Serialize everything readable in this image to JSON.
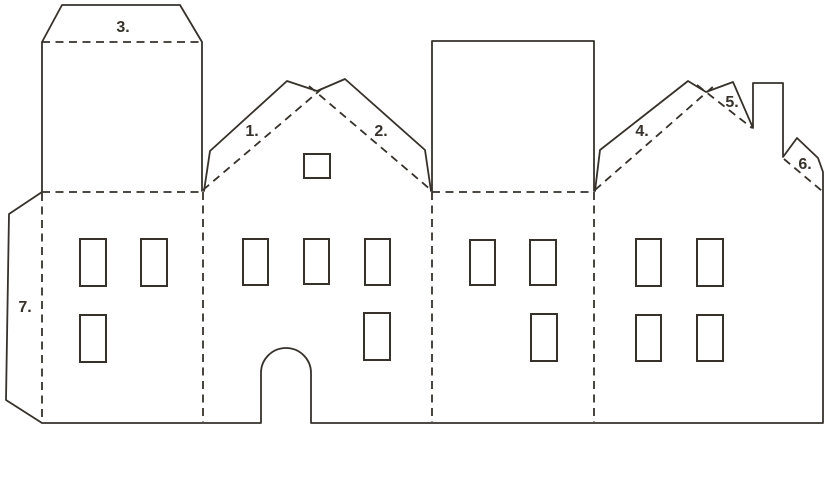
{
  "page": {
    "background_color": "#ffffff",
    "line_color": "#36312b",
    "label_color": "#36312b"
  },
  "diagram": {
    "type": "paper-house-craft-template",
    "description": "Cut-out and fold template of four connected house facades: tower house with top flap, gabled house with arched door, flat parapet house, gabled house with chimney; numbered fold flaps 1-7",
    "labels": [
      {
        "id": "fold-1",
        "text": "1."
      },
      {
        "id": "fold-2",
        "text": "2."
      },
      {
        "id": "fold-3",
        "text": "3."
      },
      {
        "id": "fold-4",
        "text": "4."
      },
      {
        "id": "fold-5",
        "text": "5."
      },
      {
        "id": "fold-6",
        "text": "6."
      },
      {
        "id": "fold-7",
        "text": "7."
      }
    ],
    "facades": [
      {
        "name": "tower-house",
        "windows": 3,
        "features": "tall tower with trapezoid glue flap (3.), side glue tab (7.)"
      },
      {
        "name": "gabled-house-with-door",
        "windows": 5,
        "features": "roof flaps 1. and 2., small gable window, arched doorway"
      },
      {
        "name": "parapet-house",
        "windows": 3,
        "features": "tall rectangular parapet"
      },
      {
        "name": "gabled-house-with-chimney",
        "windows": 4,
        "features": "roof flaps 4., 5. and 6., square chimney"
      }
    ]
  }
}
